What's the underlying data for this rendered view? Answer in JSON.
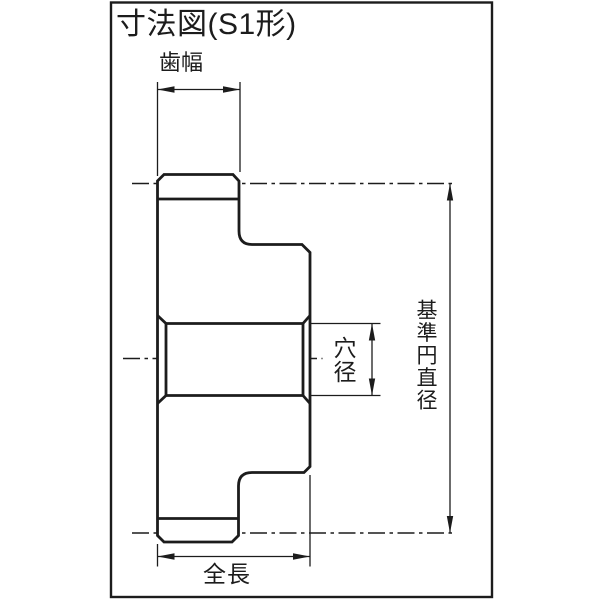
{
  "title": "寸法図(S1形)",
  "drawing": {
    "type": "gear-cross-section-dimension-diagram",
    "gear_form": "S1",
    "labels": {
      "face_width": "歯幅",
      "bore_diameter": "穴径",
      "pitch_diameter": "基準円直径",
      "overall_length": "全長"
    }
  },
  "colors": {
    "line": "#1c1c1c",
    "background": "#ffffff"
  }
}
